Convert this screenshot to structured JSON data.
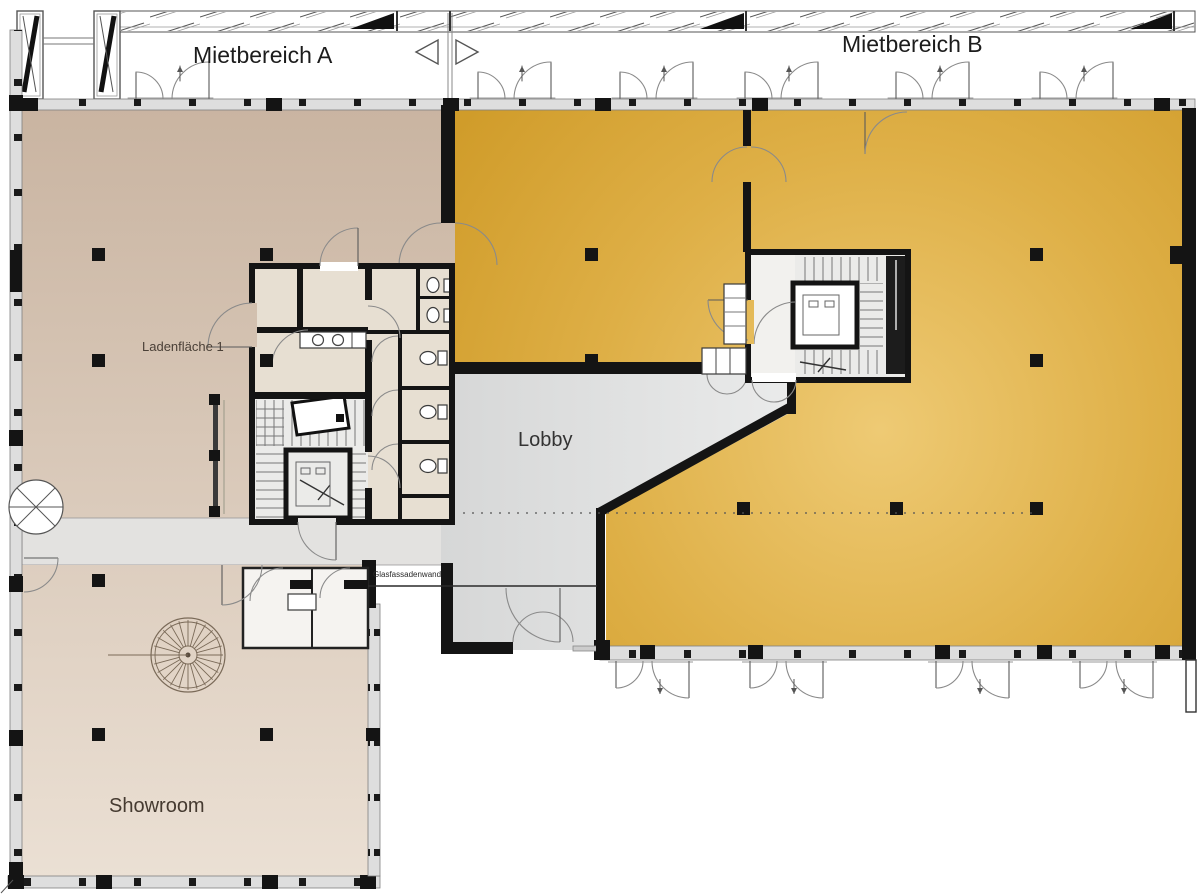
{
  "plan": {
    "labels": {
      "tenant_area_a": "Mietbereich A",
      "tenant_area_b": "Mietbereich B",
      "retail_space": "Ladenfläche 1",
      "lobby": "Lobby",
      "showroom": "Showroom",
      "glass_facade_wall": "Glasfassadenwand"
    },
    "colors": {
      "wall": "#141414",
      "tan_top": "#c9b4a1",
      "tan_bottom": "#ebe0d4",
      "gold_center": "#eeca74",
      "gold_mid": "#deaf46",
      "gold_edge": "#d09c2a",
      "lobby_left": "#d6d7d7",
      "lobby_right": "#eaebeb",
      "facade_band": "#dedede",
      "corridor": "#e3e2e0",
      "core_beige": "#e7dfd2",
      "core_gray": "#ebebe9"
    }
  }
}
